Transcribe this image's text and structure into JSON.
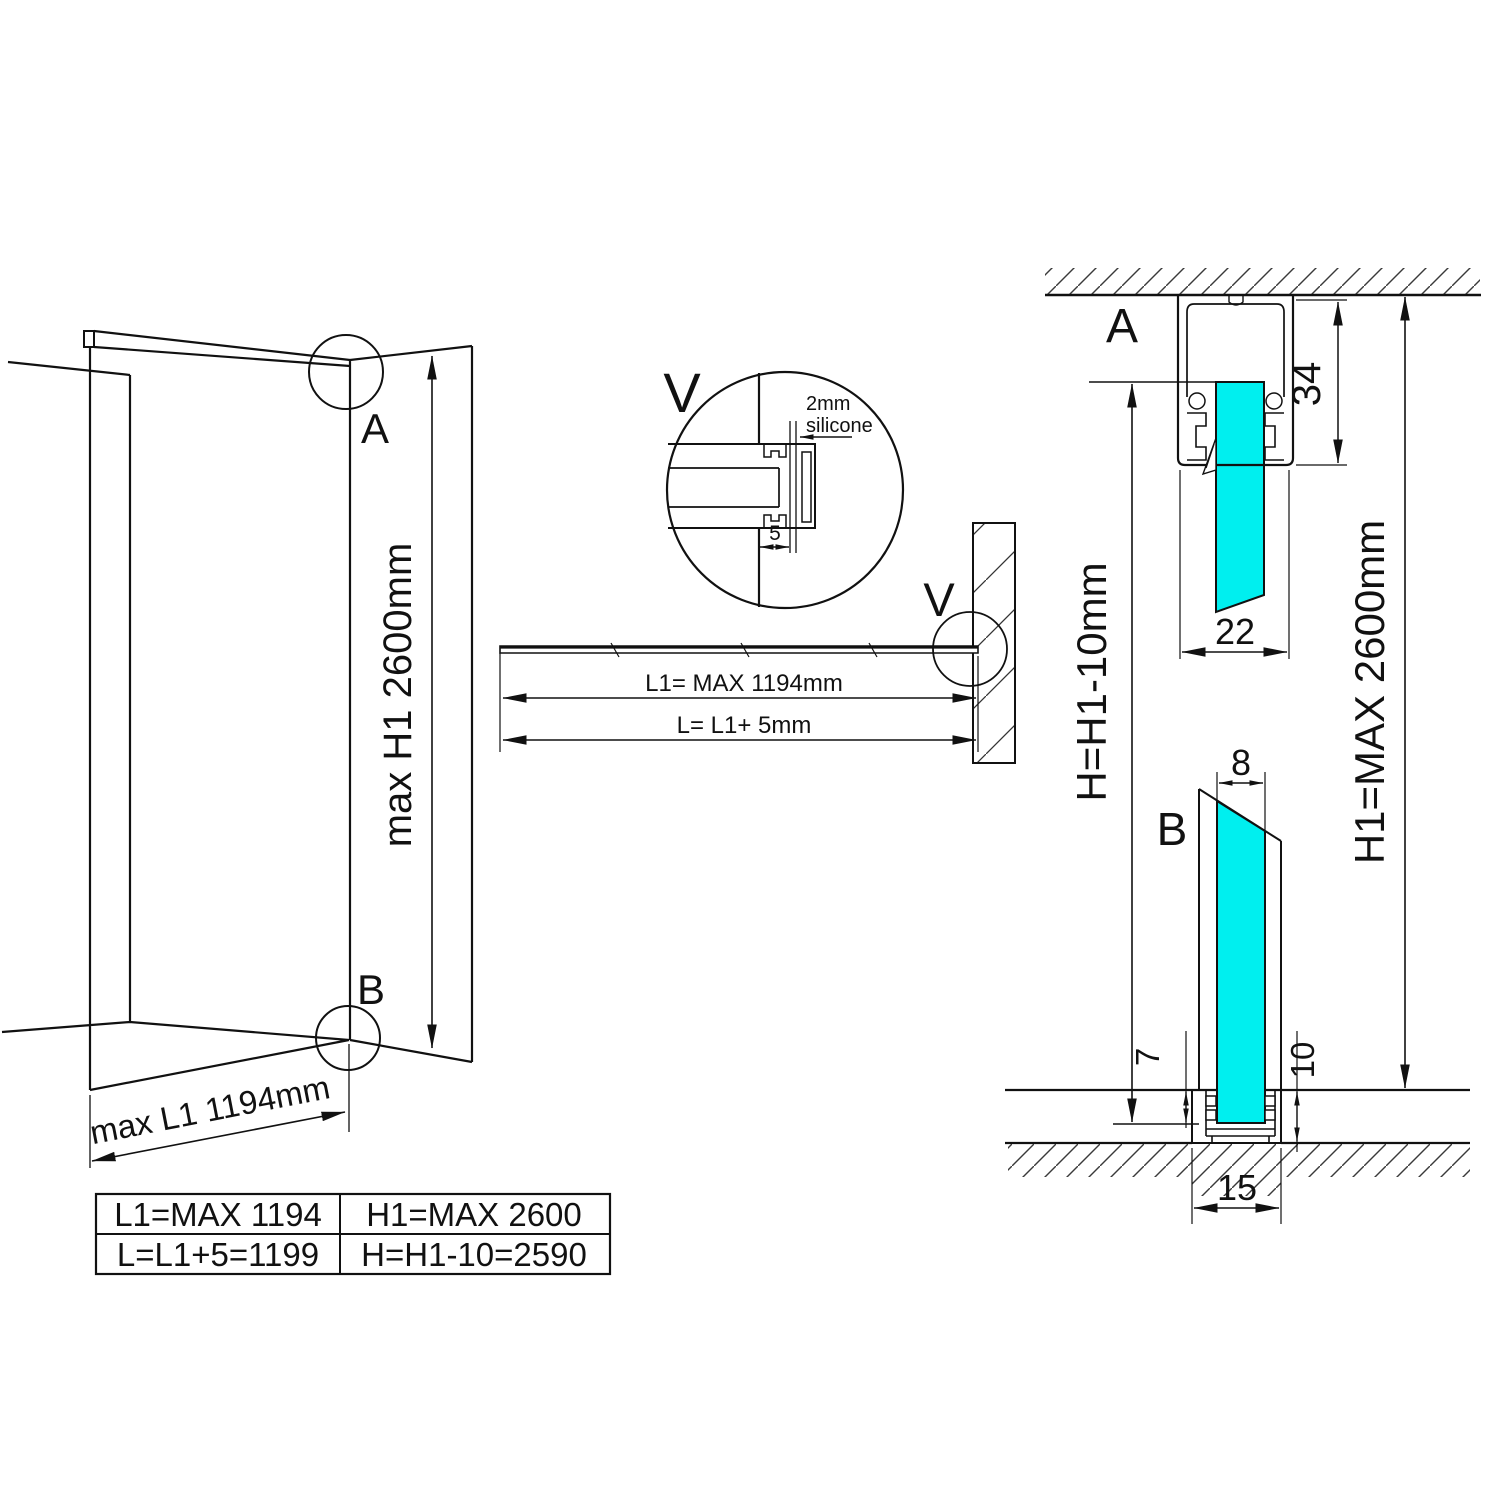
{
  "drawing": {
    "overview": {
      "label_a": "A",
      "label_b": "B",
      "dim_h1": "max H1 2600mm",
      "dim_l1": "max L1 1194mm"
    },
    "detail_v": {
      "label": "V",
      "note_line1": "2mm",
      "note_line2": "silicone",
      "dim_gap": "5"
    },
    "plan": {
      "label_v": "V",
      "dim_l1": "L1= MAX 1194mm",
      "dim_l": "L= L1+ 5mm"
    },
    "section": {
      "label_a": "A",
      "label_b": "B",
      "dim_profile_height": "34",
      "dim_profile_width": "22",
      "dim_glass_thickness": "8",
      "dim_floor_gap": "7",
      "dim_floor_depth": "10",
      "dim_bottom_width": "15",
      "dim_h": "H=H1-10mm",
      "dim_h1": "H1=MAX 2600mm"
    },
    "table": {
      "rows": [
        [
          "L1=MAX 1194",
          "H1=MAX 2600"
        ],
        [
          "L=L1+5=1199",
          "H=H1-10=2590"
        ]
      ]
    },
    "colors": {
      "glass": "#00efef",
      "line": "#111111",
      "hatch": "#3a3a3a"
    }
  }
}
